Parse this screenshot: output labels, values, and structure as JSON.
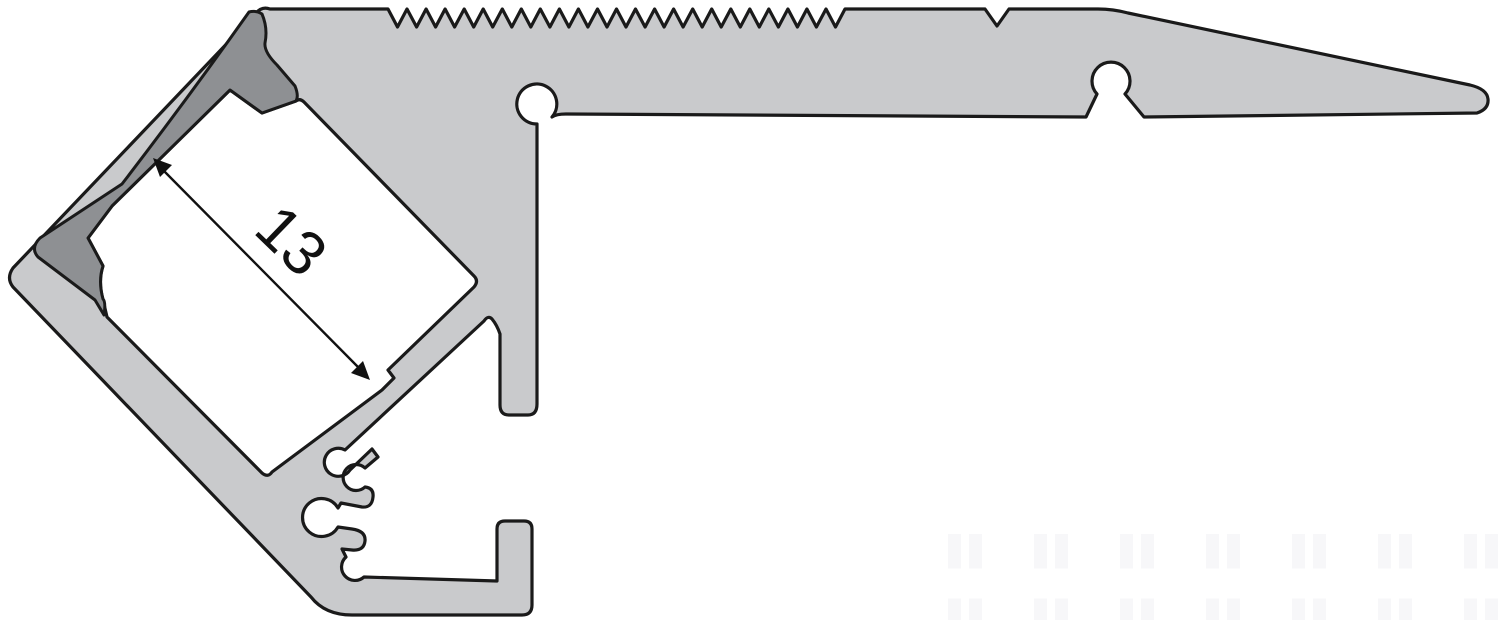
{
  "diagram": {
    "type": "technical-cross-section",
    "dimension_label": "13",
    "colors": {
      "body": "#c9cacc",
      "inner_face": "#8e9093",
      "outline": "#1a1a1a",
      "dimension": "#111111",
      "background": "#ffffff",
      "watermark_tint": "#f7f7f9"
    }
  }
}
